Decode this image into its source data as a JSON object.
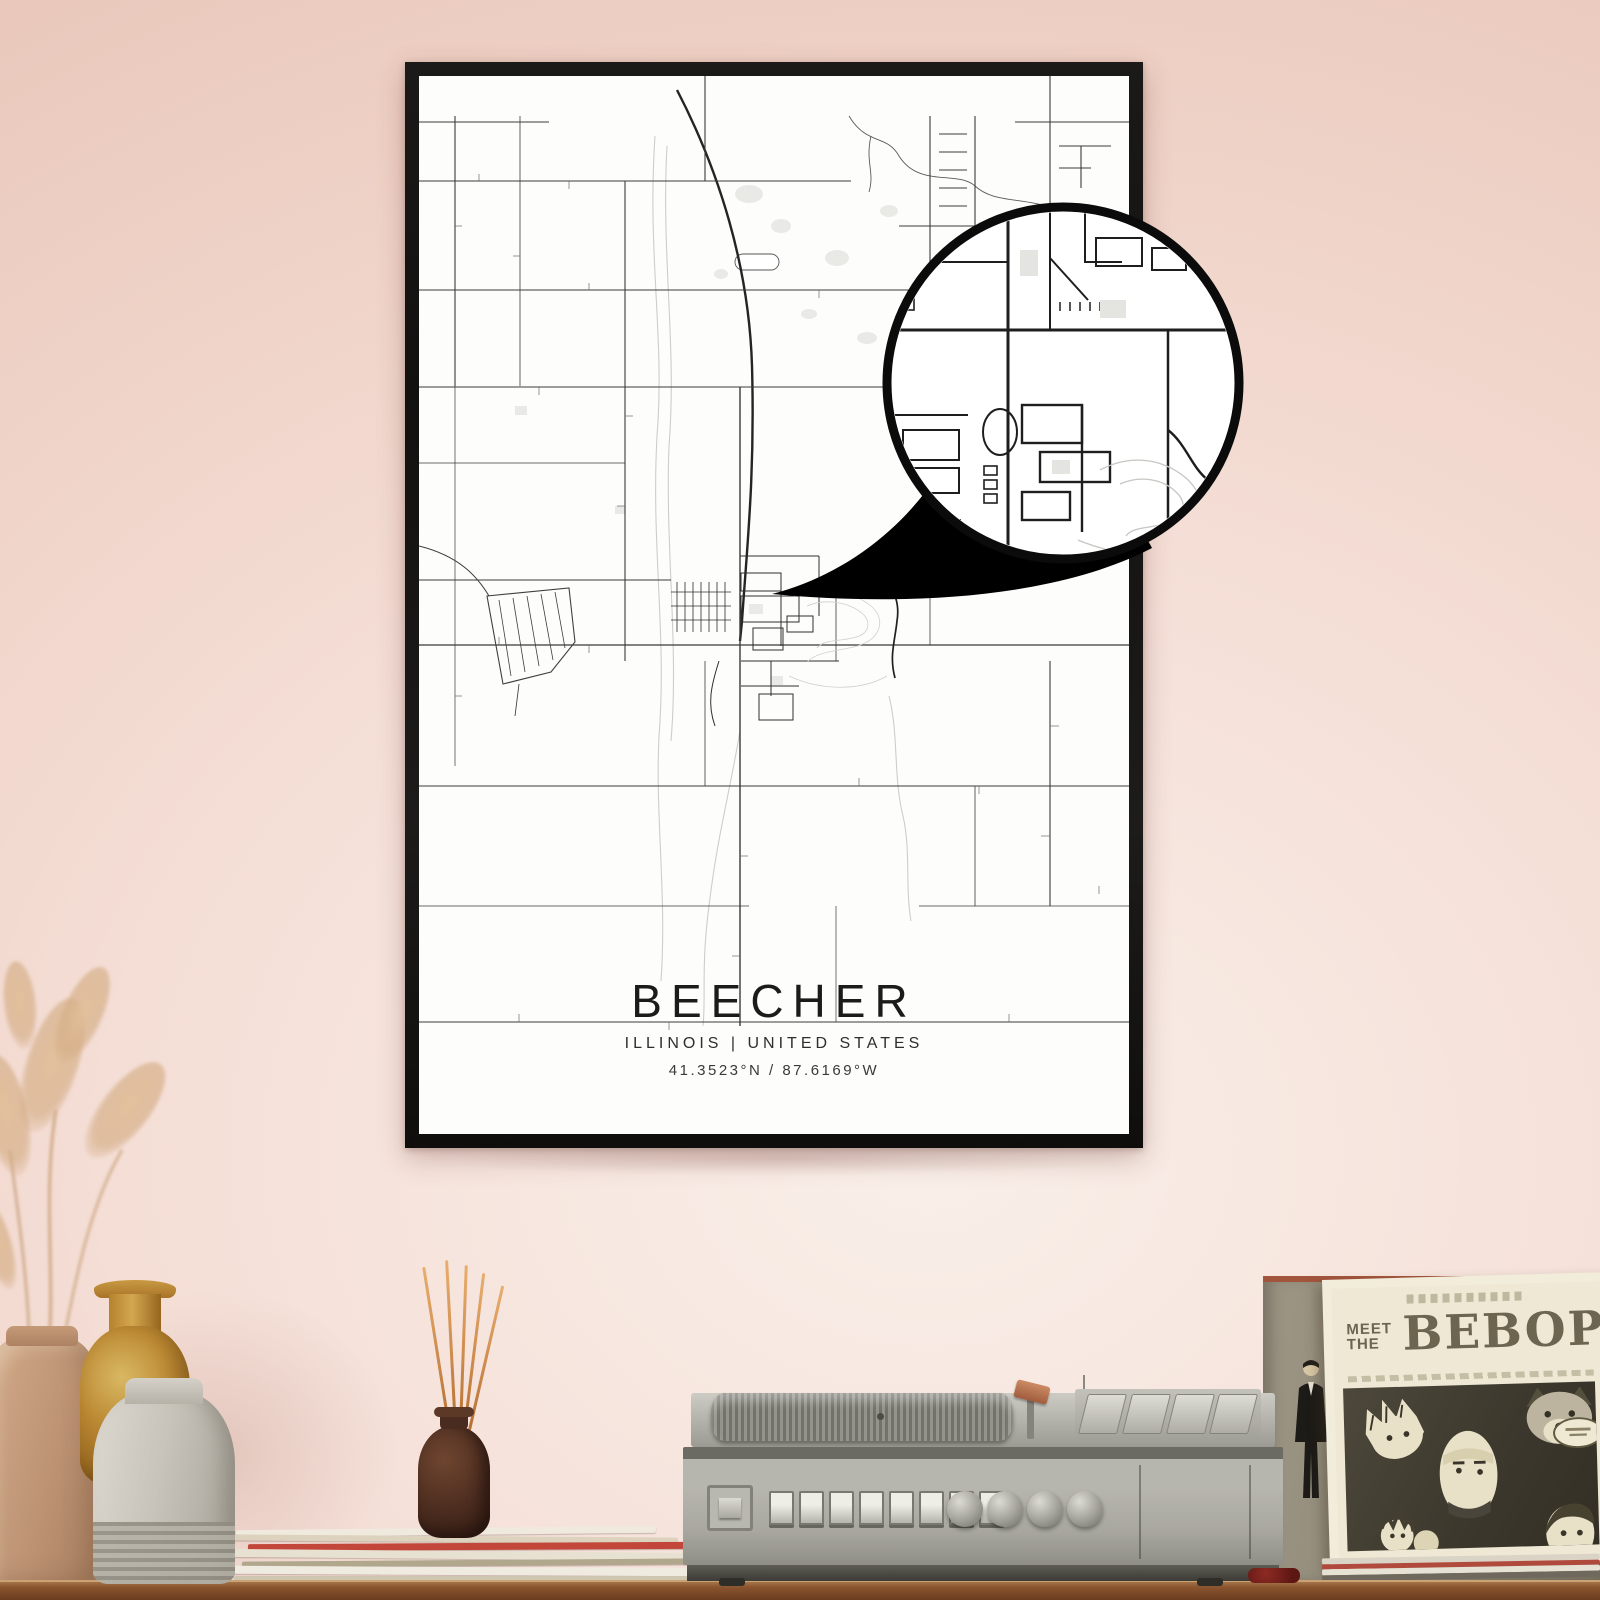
{
  "poster": {
    "title": "BEECHER",
    "region": "ILLINOIS | UNITED STATES",
    "coordinates": "41.3523°N / 87.6169°W",
    "frame_color": "#151412",
    "paper_color": "#fdfdfb",
    "road_color": "#333333",
    "water_color": "#c9c9c9"
  },
  "magnifier": {
    "ring_color": "#0b0b0b",
    "pointer_color": "#000000"
  },
  "album": {
    "pre_line_1": "MEET",
    "pre_line_2": "THE",
    "title": "BEBOP",
    "ink_color": "#6d6550",
    "cover_background": "#3b372c",
    "sleeve_color": "#f2ecdb"
  },
  "scene": {
    "wall_color": "#efd2c7",
    "shelf_color": "#8a552f",
    "player_body_color": "#b2b1a9",
    "diffuser_stick_color": "#c97f44",
    "vase_colors": [
      "#bd9373",
      "#bd8a34",
      "#c8c4bb"
    ]
  }
}
